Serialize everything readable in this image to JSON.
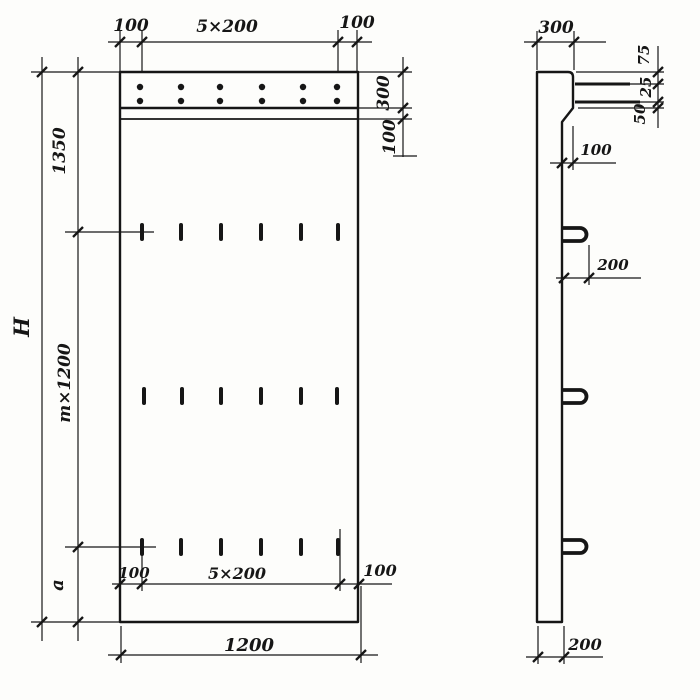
{
  "drawing_type": "precast concrete panel working drawing, front view and side view",
  "colors": {
    "ink": "#161616",
    "paper": "#fdfdfb"
  },
  "front": {
    "top": {
      "left": "100",
      "mid": "5×200",
      "right": "100"
    },
    "right": {
      "cap": "300",
      "strip": "100"
    },
    "left": {
      "overall": "H",
      "upper": "1350",
      "module": "m×1200",
      "lower": "a"
    },
    "bottom_inner": {
      "left": "100",
      "mid": "5×200",
      "right": "100"
    },
    "bottom": {
      "width": "1200"
    }
  },
  "side": {
    "top_width": "300",
    "edge_chain": {
      "top": "75",
      "mid": "25",
      "bottom": "50"
    },
    "step": "100",
    "loop": "200",
    "thickness": "200"
  }
}
